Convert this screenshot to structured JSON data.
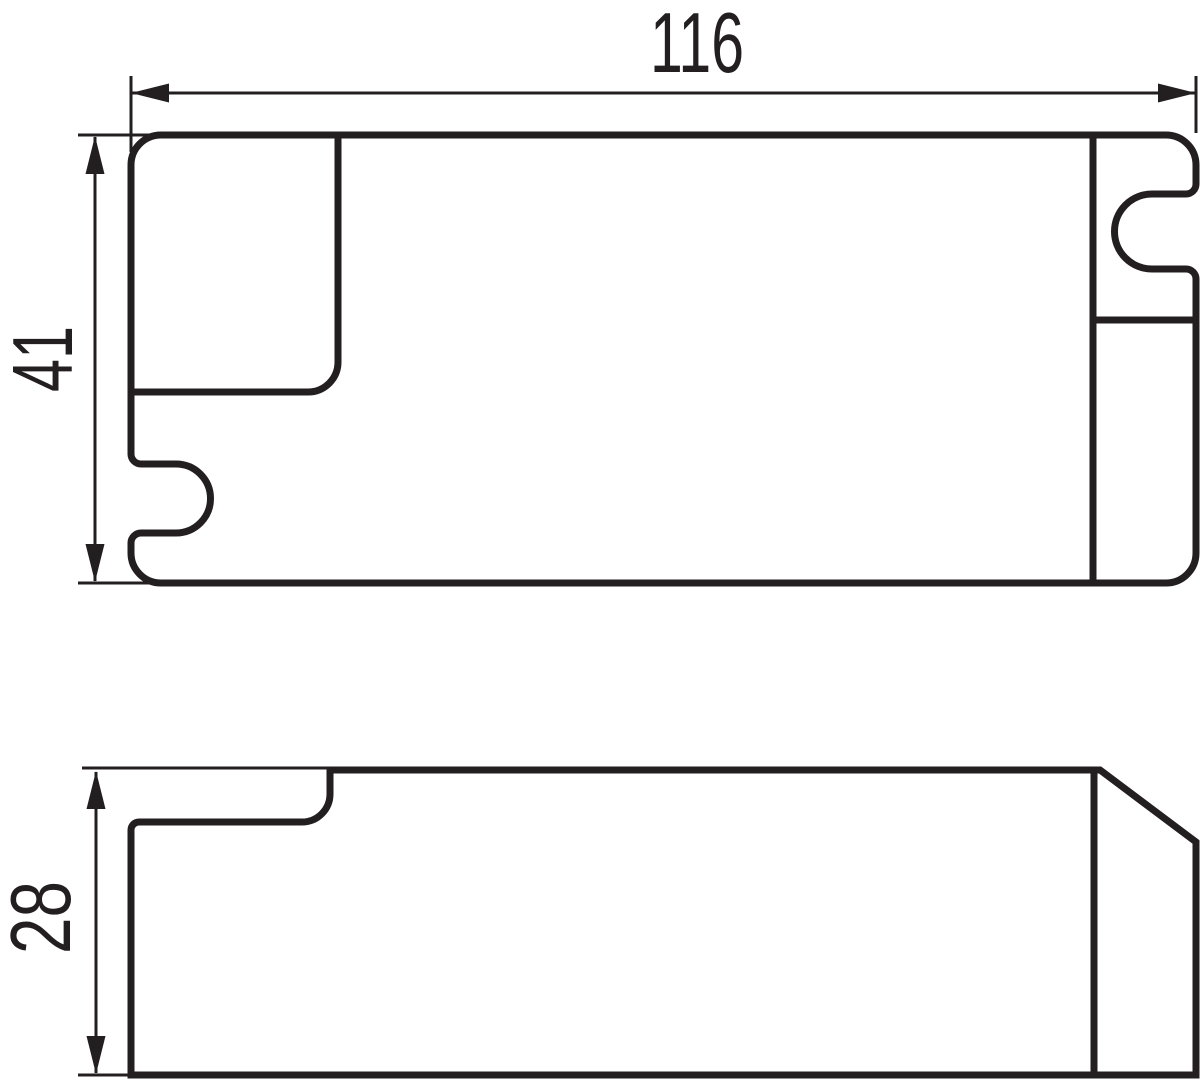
{
  "colors": {
    "line": "#231f20",
    "background": "#ffffff"
  },
  "dimensions": {
    "width": {
      "label": "116"
    },
    "height": {
      "label": "41"
    },
    "depth": {
      "label": "28"
    }
  }
}
